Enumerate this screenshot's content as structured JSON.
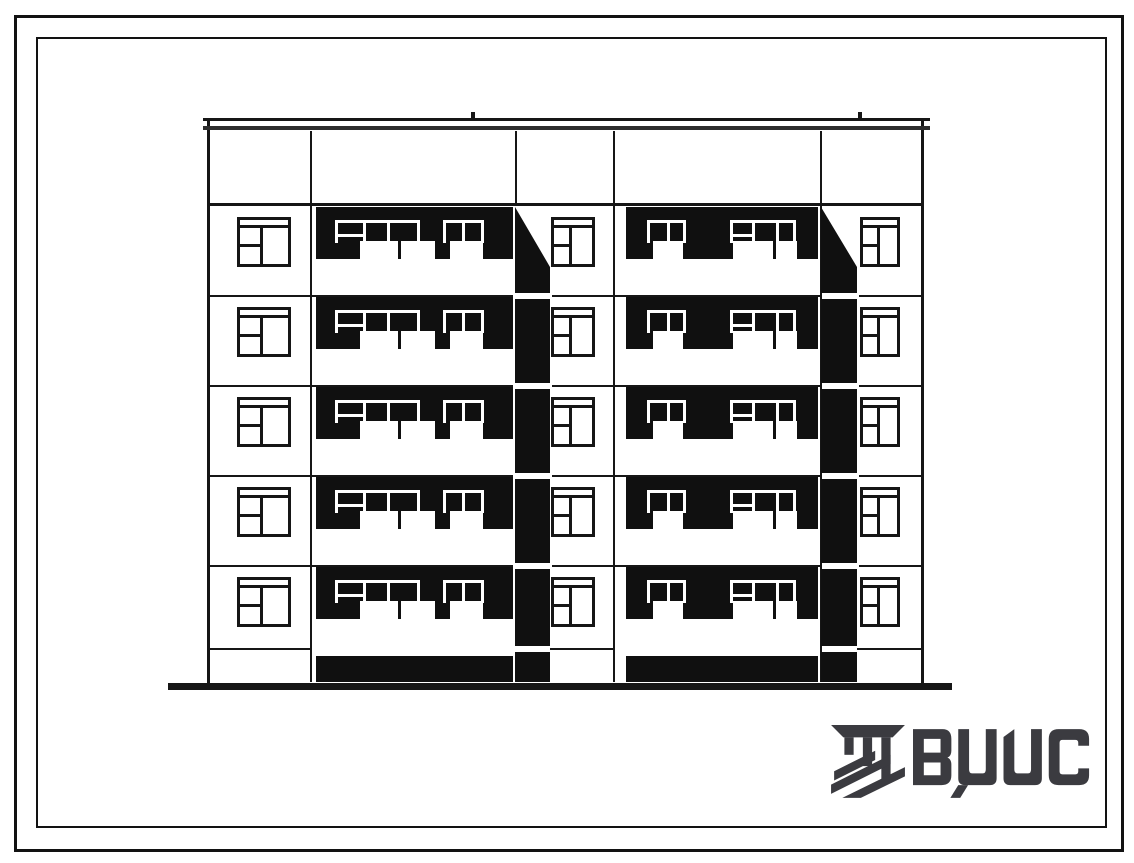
{
  "document": {
    "kind": "scanned architectural elevation drawing, 5-storey apartment block",
    "logo_text": "ВЦИС"
  },
  "colors": {
    "paper": "#ffffff",
    "ink": "#161616",
    "shadow": "#101010",
    "logo": "#3b3b40"
  },
  "facade": {
    "left": 207,
    "right": 921,
    "top": 120,
    "bottom": 682,
    "roof": {
      "x1": 203,
      "w": 727,
      "band1_y": 118,
      "band2_y": 126,
      "ticks": [
        471,
        858
      ]
    },
    "attic": {
      "bottom_y": 203,
      "verticals": [
        310,
        515,
        613,
        820
      ]
    },
    "floor_count": 5,
    "floor_tops": [
      207,
      297,
      387,
      477,
      567
    ],
    "floor_lines": [
      295,
      385,
      475,
      565
    ],
    "line_segments_x": [
      [
        208,
        513
      ],
      [
        552,
        820
      ],
      [
        859,
        921
      ]
    ],
    "plinth": {
      "y": 648,
      "segments": [
        [
          208,
          310
        ],
        [
          550,
          613
        ],
        [
          857,
          921
        ]
      ]
    },
    "zone_verticals": [
      310,
      613,
      820
    ],
    "piers": [
      {
        "win_x": 237,
        "win_w": 54
      },
      {
        "win_x": 551,
        "win_w": 44
      },
      {
        "win_x": 860,
        "win_w": 40
      }
    ],
    "zones": [
      {
        "band_x": 316,
        "band_w": 197,
        "groups": [
          {
            "verticals": [
              335,
              363,
              387,
              417
            ],
            "door": [
              335,
              363
            ],
            "sills": [
              [
                360,
                38
              ],
              [
                401,
                34
              ]
            ]
          },
          {
            "verticals": [
              443,
              462,
              481
            ],
            "sills": [
              [
                450,
                33
              ]
            ]
          }
        ]
      },
      {
        "band_x": 626,
        "band_w": 192,
        "groups": [
          {
            "verticals": [
              647,
              667,
              683
            ],
            "sills": [
              [
                653,
                30
              ]
            ]
          },
          {
            "verticals": [
              730,
              752,
              776,
              793
            ],
            "door": [
              730,
              752
            ],
            "sills": [
              [
                733,
                40
              ],
              [
                776,
                21
              ]
            ]
          }
        ]
      }
    ],
    "shafts": [
      {
        "x": 515,
        "w": 35
      },
      {
        "x": 821,
        "w": 36
      }
    ],
    "shaft_seg_tops": [
      267,
      299,
      389,
      479,
      569,
      652
    ],
    "shaft_seg_bottoms": [
      293,
      383,
      473,
      563,
      646,
      682
    ],
    "base_strips": [
      [
        316,
        197
      ],
      [
        626,
        192
      ]
    ],
    "ground": {
      "x": 168,
      "w": 784,
      "y": 683,
      "h": 7
    }
  }
}
